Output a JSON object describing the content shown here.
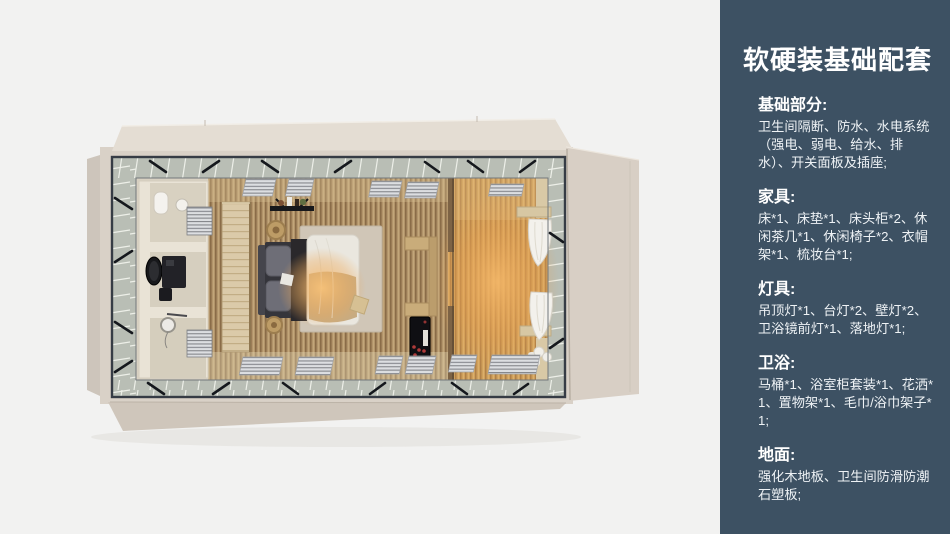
{
  "page": {
    "background": "#f2f2f1",
    "width": 950,
    "height": 534
  },
  "floorplan": {
    "colors": {
      "shell_beige": "#d9d1c7",
      "roof_flap": "#e4ddd3",
      "glass_band": "#b9beb5",
      "steel_frame": "#363c45",
      "bedroom_wood": "#b2946a",
      "lounge_warm_wood": "#cfa15c",
      "bathroom_floor": "#d8d1c2",
      "warm_glow": "#f4b768"
    }
  },
  "sidebar": {
    "background": "#3d5163",
    "text_color": "#ffffff",
    "title": "软硬装基础配套",
    "sections": [
      {
        "heading": "基础部分:",
        "body": "卫生间隔断、防水、水电系统（强电、弱电、给水、排水）、开关面板及插座;"
      },
      {
        "heading": "家具:",
        "body": "床*1、床垫*1、床头柜*2、休闲茶几*1、休闲椅子*2、衣帽架*1、梳妆台*1;"
      },
      {
        "heading": "灯具:",
        "body": "吊顶灯*1、台灯*2、壁灯*2、卫浴镜前灯*1、落地灯*1;"
      },
      {
        "heading": "卫浴:",
        "body": "马桶*1、浴室柜套装*1、花洒*1、置物架*1、毛巾/浴巾架子*1;"
      },
      {
        "heading": "地面:",
        "body": "强化木地板、卫生间防滑防潮石塑板;"
      }
    ]
  }
}
